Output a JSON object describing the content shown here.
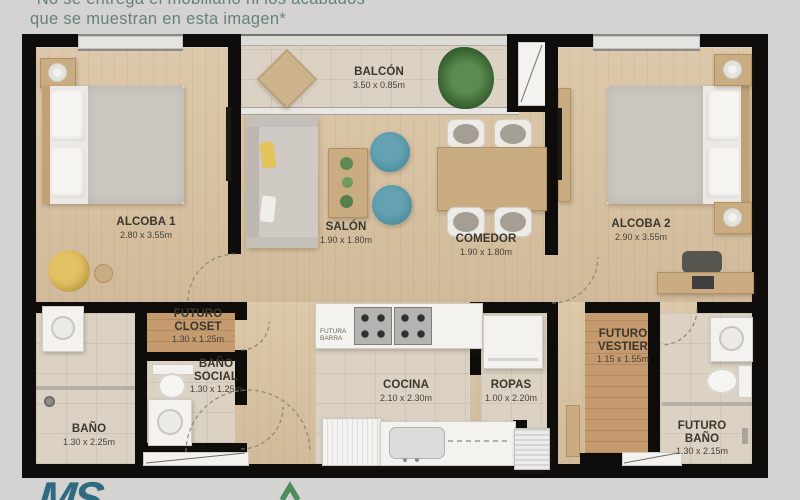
{
  "disclaimer": {
    "line1": "*No se entrega el mobiliario ni los acabados",
    "line2": "que se muestran en esta imagen*"
  },
  "rooms": {
    "alcoba1": {
      "name": "ALCOBA 1",
      "dims": "2.80 x 3.55m"
    },
    "balcon": {
      "name": "BALCÓN",
      "dims": "3.50 x 0.85m"
    },
    "salon": {
      "name": "SALÓN",
      "dims": "1.90 x 1.80m"
    },
    "comedor": {
      "name": "COMEDOR",
      "dims": "1.90 x 1.80m"
    },
    "alcoba2": {
      "name": "ALCOBA 2",
      "dims": "2.90 x 3.55m"
    },
    "futuro_closet": {
      "name": "FUTURO CLOSET",
      "dims": "1.30 x 1.25m"
    },
    "bano_social": {
      "name": "BAÑO SOCIAL",
      "dims": "1.30 x 1.25m"
    },
    "bano": {
      "name": "BAÑO",
      "dims": "1.30 x 2.25m"
    },
    "cocina": {
      "name": "COCINA",
      "dims": "2.10 x 2.30m"
    },
    "ropas": {
      "name": "ROPAS",
      "dims": "1.00 x 2.20m"
    },
    "futuro_vestier": {
      "name": "FUTURO VESTIER",
      "dims": "1.15 x 1.55m"
    },
    "futuro_bano": {
      "name": "FUTURO BAÑO",
      "dims": "1.30 x 2.15m"
    }
  },
  "annotations": {
    "futura_barra": "FUTURA BARRA"
  },
  "footer": {
    "logo": "MS"
  },
  "colors": {
    "wall": "#0f0d0b",
    "wood_floor": "#d9c2a1",
    "dark_wood_floor": "#c49a6e",
    "tile_floor": "#dbd2c3",
    "pouf_teal": "#4f91a1",
    "accent_yellow": "#e3c264",
    "chevron_green": "#4d8c5e",
    "logo_teal": "#2e6a80",
    "disclaimer_text": "#66817b",
    "label_text": "#3a362c"
  }
}
